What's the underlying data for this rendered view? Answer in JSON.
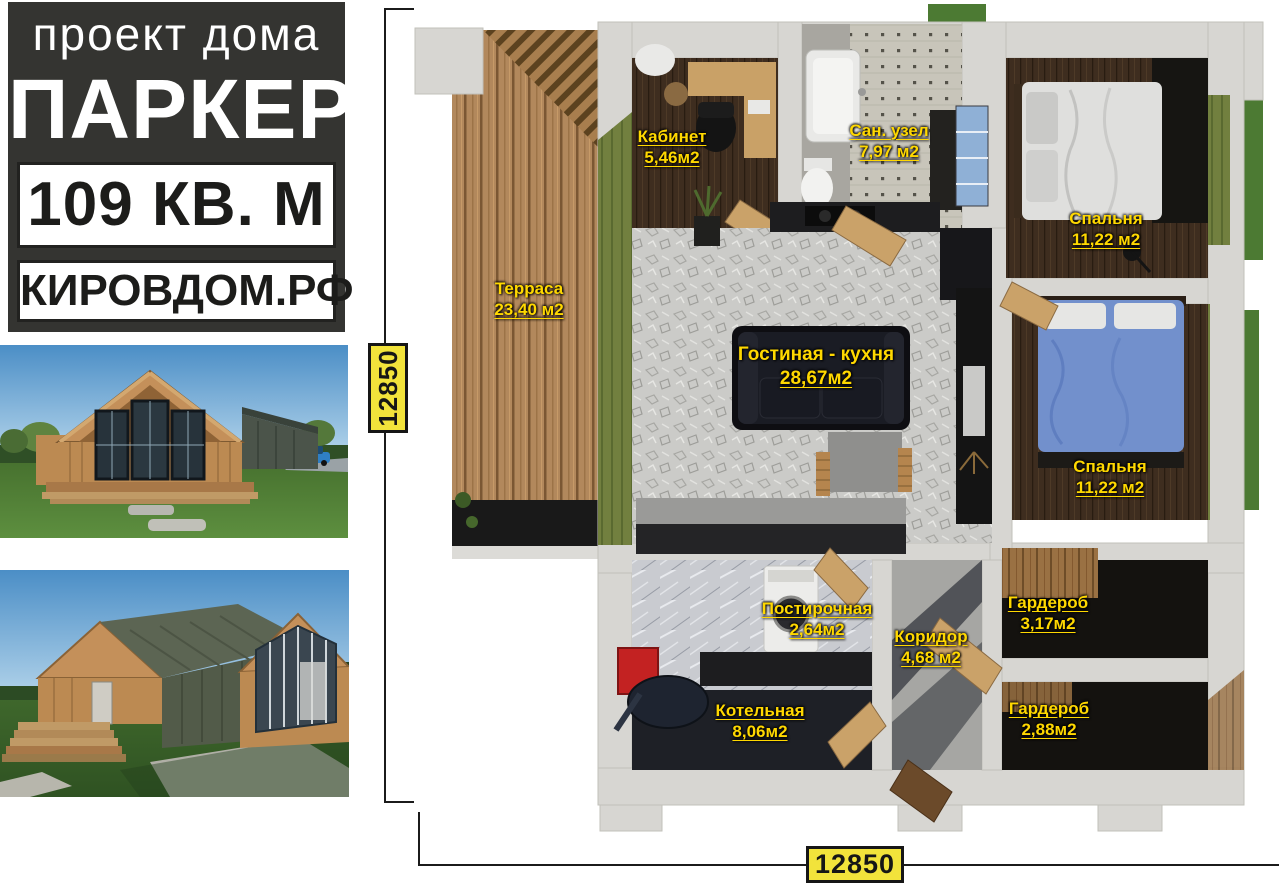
{
  "title_block": {
    "subtitle": "проект дома",
    "name": "ПАРКЕР",
    "area": "109 КВ. М",
    "website": "КИРОВДОМ.РФ"
  },
  "plan": {
    "rooms": [
      {
        "name": "Кабинет",
        "area": "5,46м2"
      },
      {
        "name": "Сан. узел",
        "area": "7,97 м2"
      },
      {
        "name": "Спальня",
        "area": "11,22 м2"
      },
      {
        "name": "Терраса",
        "area": "23,40 м2"
      },
      {
        "name": "Гостиная - кухня",
        "area": "28,67м2"
      },
      {
        "name": "Спальня",
        "area": "11,22 м2"
      },
      {
        "name": "Постирочная",
        "area": "2,64м2"
      },
      {
        "name": "Коридор",
        "area": "4,68 м2"
      },
      {
        "name": "Гардероб",
        "area": "3,17м2"
      },
      {
        "name": "Котельная",
        "area": "8,06м2"
      },
      {
        "name": "Гардероб",
        "area": "2,88м2"
      }
    ],
    "dimensions": {
      "width": "12850",
      "height": "12850"
    }
  },
  "colors": {
    "room_label": "#ffd800",
    "dimension_box_bg": "#f2e33b",
    "title_block_bg": "#343431",
    "accent_olive": "#6d7b3f"
  }
}
